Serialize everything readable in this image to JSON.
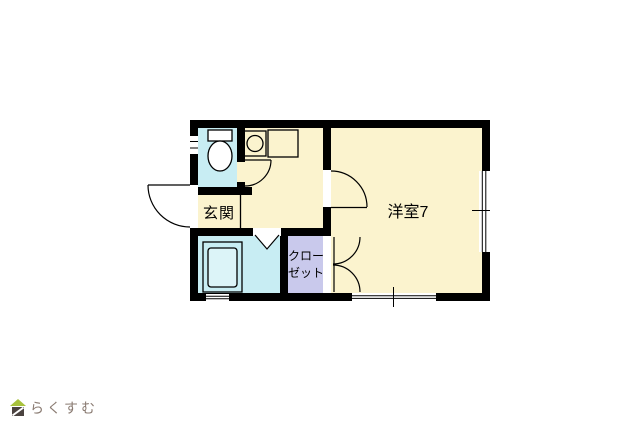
{
  "floorplan": {
    "labels": {
      "entrance": "玄関",
      "western_room": "洋室7",
      "closet_line1": "クロー",
      "closet_line2": "ゼット"
    },
    "colors": {
      "floor": "#FBF3CE",
      "wet_room": "#C8EDF3",
      "closet": "#C9C9EC",
      "wall": "#000000",
      "bathtub": "#DCF4F8"
    }
  },
  "branding": {
    "logo_icon": "house-icon",
    "logo_text": "らくすむ",
    "logo_text_color": "#8A7B72",
    "logo_roof_color": "#A8C23C",
    "logo_house_color": "#4B4340"
  }
}
